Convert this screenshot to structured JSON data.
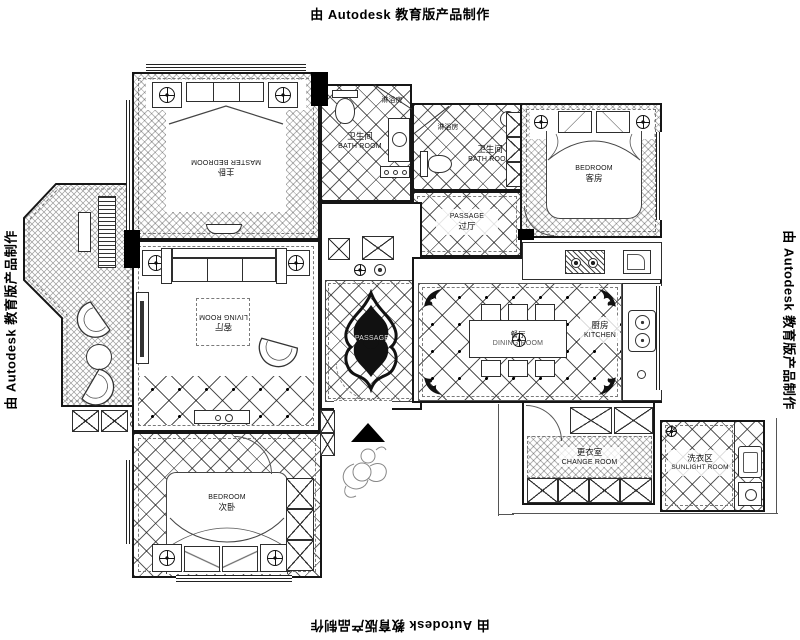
{
  "watermark": "由 Autodesk 教育版产品制作",
  "rooms": {
    "master_bedroom": {
      "zh": "主卧",
      "en": "MASTER BEDROOM"
    },
    "bathroom_1": {
      "zh": "卫生间",
      "en": "BATH ROOM"
    },
    "shower_1": {
      "zh": "淋浴房"
    },
    "bathroom_2": {
      "zh": "卫生间",
      "en": "BATH ROOM"
    },
    "shower_2": {
      "zh": "淋浴房"
    },
    "guest_bedroom": {
      "en": "BEDROOM",
      "zh": "客房"
    },
    "passage": {
      "en": "PASSAGE",
      "zh": "过厅"
    },
    "corridor": {
      "en": "PASSAGE"
    },
    "living_room": {
      "zh": "客厅",
      "en": "LIVING ROOM"
    },
    "dining_room": {
      "zh": "餐厅",
      "en": "DINING ROOM"
    },
    "kitchen": {
      "zh": "厨房",
      "en": "KITCHEN"
    },
    "second_bedroom": {
      "en": "BEDROOM",
      "zh": "次卧"
    },
    "change_room": {
      "zh": "更衣室",
      "en": "CHANGE ROOM"
    },
    "sunlight_room": {
      "zh": "洗衣区",
      "en": "SUNLIGHT ROOM"
    }
  },
  "colors": {
    "line": "#161616",
    "paper": "#ffffff",
    "ornament": "#111111"
  }
}
